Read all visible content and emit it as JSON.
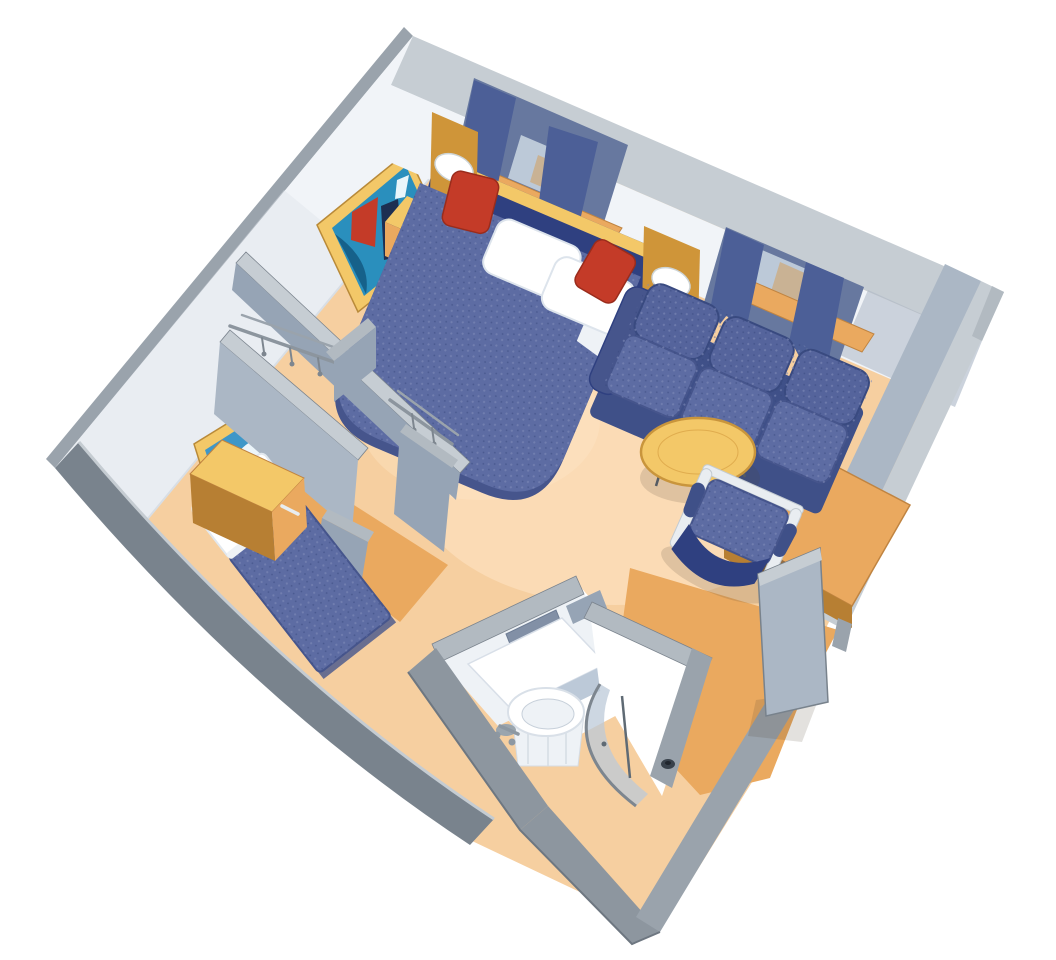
{
  "scene": {
    "title": "isometric-cutaway-floor-plan-cruise-stateroom",
    "view": "3d-cutaway-top-oblique",
    "background": "#ffffff",
    "rooms": [
      {
        "name": "main-cabin",
        "contents": [
          "double-bed",
          "headboard",
          "reading-lamps",
          "nightstands",
          "window-with-curtains-behind-bed",
          "sofa",
          "window-with-curtains-behind-sofa",
          "coffee-table",
          "armchair",
          "desk",
          "framed-ship-art"
        ]
      },
      {
        "name": "second-bedroom",
        "contents": [
          "single-bed",
          "overhead-cabinet",
          "framed-clouds-art"
        ]
      },
      {
        "name": "closets",
        "contents": [
          "hanging-rails",
          "hangers"
        ]
      },
      {
        "name": "bathroom",
        "contents": [
          "vanity-counter",
          "round-sink",
          "faucet",
          "mirror"
        ]
      },
      {
        "name": "shower-room",
        "contents": [
          "curved-glass-door",
          "drain"
        ]
      },
      {
        "name": "entry",
        "contents": [
          "wood-floor",
          "open-door"
        ]
      }
    ]
  },
  "palette": {
    "bg": "#ffffff",
    "wallTop": "#c6cdd3",
    "wallTopMid": "#b2bac1",
    "wallTopDark": "#8d969f",
    "wallOuter": "#79838d",
    "wallOuterLight": "#9aa3ac",
    "wallFaceWhite": "#f1f4f8",
    "wallFaceShade": "#dfe5ec",
    "wallFaceBlue": "#abb7c5",
    "wallFaceBlueDeep": "#96a4b5",
    "wallEdge": "#6e7781",
    "carpet": "#f6cfa0",
    "carpetLight": "#ffe8c9",
    "wood": "#eaa95f",
    "woodLight": "#f3c868",
    "woodDark": "#cf9539",
    "woodDeep": "#b77f33",
    "navySkirt": "#3f5088",
    "sofaBack": "#55649c",
    "bedBlue": "#5d6ca3",
    "bedBlueDark": "#46558c",
    "headboard": "#2f4080",
    "red": "#c43b28",
    "redDark": "#9a2c1c",
    "curtain": "#4c5f97",
    "windowRecess": "#67789f",
    "glass": "#bcc9d8",
    "glassTan": "#c9b294",
    "mirror": "#8290a6",
    "chrome": "#9aa5ae",
    "tubeWhite": "#e9edf1",
    "white": "#ffffff",
    "offWhite": "#eef2f6",
    "shadow": "rgba(80,66,48,0.16)",
    "artTeal": "#2a8fbd",
    "artTealDark": "#16618a",
    "artSky": "#3e97c8",
    "artSkyDeep": "#1f6fa8",
    "artWhite": "#e9f5fa"
  }
}
